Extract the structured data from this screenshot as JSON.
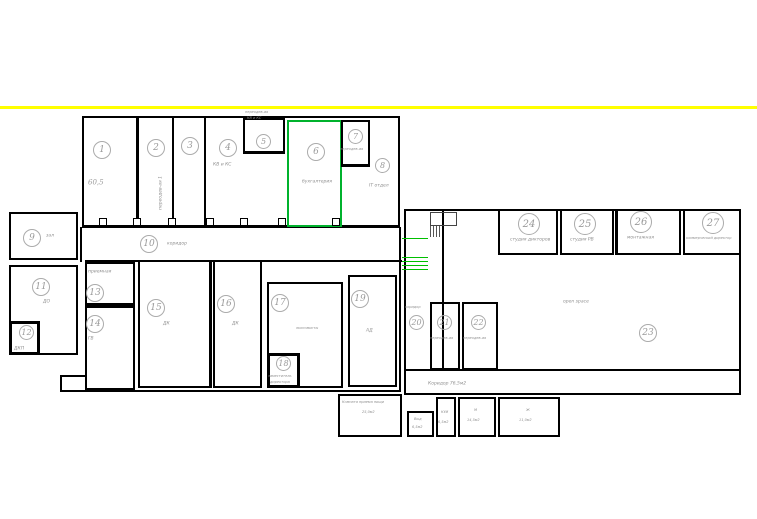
{
  "colors": {
    "highlight_green": "#00b22d",
    "accent_yellow": "#ffff00",
    "wall_black": "#000000",
    "text_gray": "#8f8f8f"
  },
  "rooms": {
    "r1": {
      "num": "1",
      "area": "60,5"
    },
    "r2": {
      "num": "2",
      "label": "переодев-ая 1"
    },
    "r3": {
      "num": "3"
    },
    "r4": {
      "num": "4",
      "label": "КВ и КС"
    },
    "r5": {
      "num": "5",
      "note_line1": "переодев-ая",
      "note_line2": "КВ и КС"
    },
    "r6": {
      "num": "6",
      "label": "бухгалтерия"
    },
    "r7": {
      "num": "7",
      "label": "переодев-ая"
    },
    "r8": {
      "num": "8",
      "label": "IT отдел"
    },
    "r9": {
      "num": "9",
      "label": "зал"
    },
    "r10": {
      "num": "10",
      "label": "коридор"
    },
    "r11": {
      "num": "11",
      "label": "ДО"
    },
    "r12": {
      "num": "12",
      "label": "ДКП"
    },
    "r13": {
      "num": "13",
      "label": "приемная"
    },
    "r14": {
      "num": "14",
      "label": "ГВ"
    },
    "r15": {
      "num": "15",
      "label": "ДК"
    },
    "r16": {
      "num": "16",
      "label": "ДК"
    },
    "r17": {
      "num": "17",
      "label": "экономисты"
    },
    "r18": {
      "num": "18",
      "label_line1": "заместитель",
      "label_line2": "директора"
    },
    "r19": {
      "num": "19",
      "label": "АД"
    },
    "r20": {
      "num": "20",
      "label": "коридор"
    },
    "r21": {
      "num": "21",
      "label": "переодев-ая"
    },
    "r22": {
      "num": "22",
      "label": "переодев-ая"
    },
    "r23": {
      "num": "23",
      "label": "open space"
    },
    "r24": {
      "num": "24",
      "label": "студия дикторов"
    },
    "r25": {
      "num": "25",
      "label": "студия РВ"
    },
    "r26": {
      "num": "26",
      "label": "монтажная"
    },
    "r27": {
      "num": "27",
      "label": "коммерческий директор"
    }
  },
  "bottom": {
    "corridor_label": "Коридор 76,5м2",
    "meal_room": {
      "line1": "Комната приема пищи",
      "line2": "25,0м2"
    },
    "room_vyd": {
      "name": "Выд",
      "area": "6,5м2"
    },
    "room_kui": {
      "name": "КУИ",
      "area": "6,5м2"
    },
    "room_m": {
      "name": "М",
      "area": "14,5м2"
    },
    "room_zh": {
      "name": "Ж",
      "area": "11,0м2"
    }
  }
}
